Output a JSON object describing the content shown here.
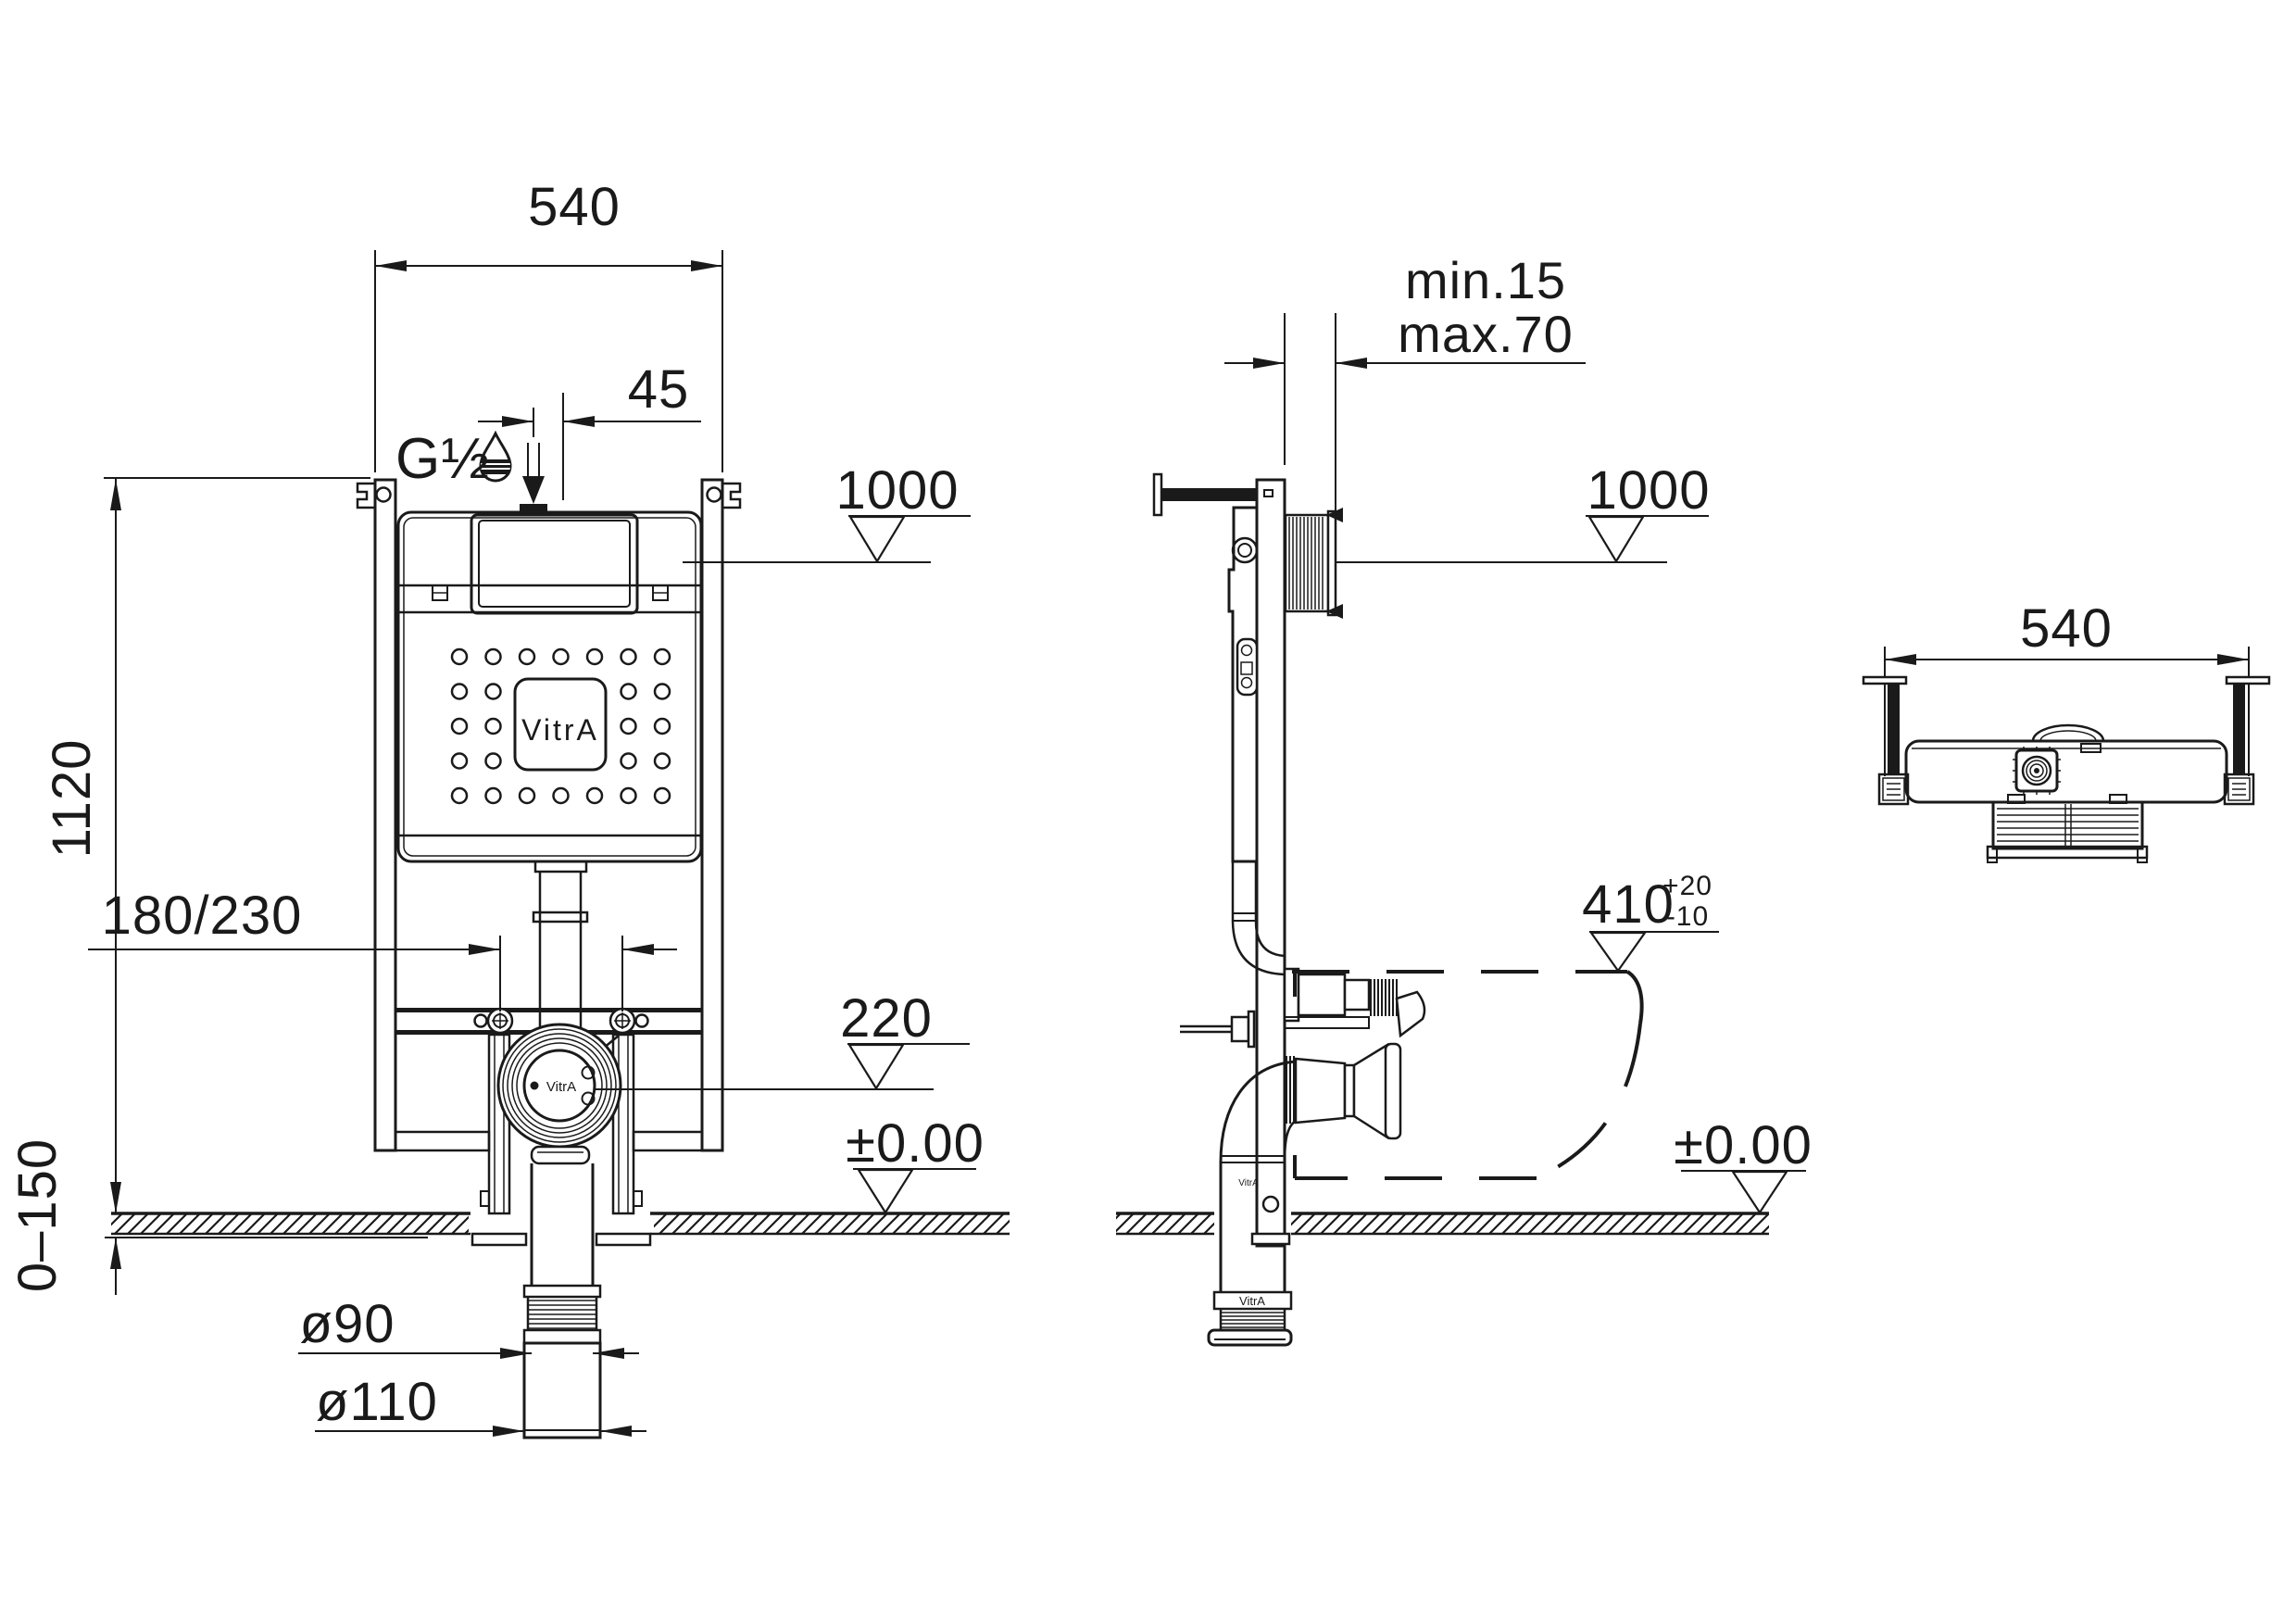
{
  "colors": {
    "ink": "#1a1a1a",
    "paper": "#ffffff"
  },
  "brand": "VitrA",
  "front_view": {
    "width": "540",
    "inlet_offset": "45",
    "inlet_thread": "G½",
    "level_cistern_top": "1000",
    "frame_height": "1120",
    "bolt_spacing": "180/230",
    "level_flush_outlet": "220",
    "level_floor": "±0.00",
    "floor_adjust_range": "0–150",
    "drain_pipe_dia": "ø90",
    "drain_socket_dia": "ø110",
    "cistern_logo": "VitrA",
    "outlet_rosette_label": "VitrA"
  },
  "side_view": {
    "wall_distance_min": "min.15",
    "wall_distance_max": "max.70",
    "level_cistern_top": "1000",
    "bowl_projection": "410",
    "bowl_projection_tol_plus": "+20",
    "bowl_projection_tol_minus": "-10",
    "level_floor": "±0.00",
    "drain_coupling_label": "VitrA",
    "pipe_label_small": "VitrA"
  },
  "top_view": {
    "width": "540"
  }
}
